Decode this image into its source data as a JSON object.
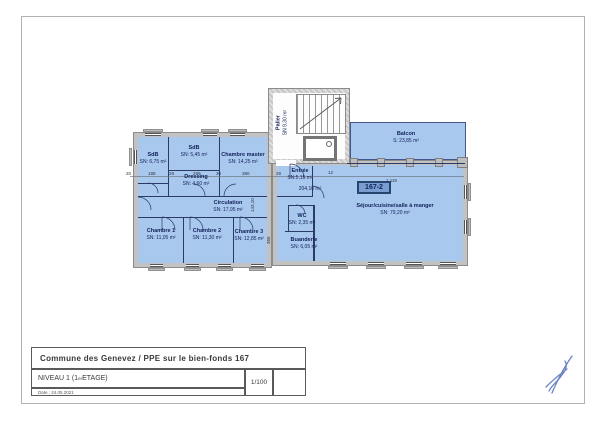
{
  "sheet": {
    "title_block": {
      "title": "Commune des Genevez / PPE sur le bien-fonds 167",
      "level_prefix": "NIVEAU 1 (1",
      "level_sup": "er",
      "level_suffix": " ETAGE)",
      "scale": "1/100",
      "date": "Date : 24.05.2021"
    },
    "icons": {
      "compass_icon": "north-compass",
      "signature_icon": "handwritten-initials"
    },
    "colors": {
      "room_fill": "#a8c8ee",
      "wall_gray": "#c2c2c2",
      "badge_bg": "#7b9cd0",
      "badge_border": "#24466e",
      "line_navy": "#2c3a66",
      "signature_blue": "#5c77bd"
    }
  },
  "plan": {
    "unit_badge": "167-2",
    "total_area": "204,10 m²",
    "rooms": [
      {
        "name": "SdB",
        "area": "SN: 6,75 m²"
      },
      {
        "name": "SdB",
        "area": "SN: 5,45 m²"
      },
      {
        "name": "Dressing",
        "area": "SN: 4,60 m²"
      },
      {
        "name": "Chambre master",
        "area": "SN: 14,25 m²"
      },
      {
        "name": "Circulation",
        "area": "SN: 17,95 m²"
      },
      {
        "name": "Chambre 1",
        "area": "SN: 11,05 m²"
      },
      {
        "name": "Chambre 2",
        "area": "SN: 11,30 m²"
      },
      {
        "name": "Chambre 3",
        "area": "SN: 12,85 m²"
      },
      {
        "name": "Palier",
        "area": "SN 9,30 m²"
      },
      {
        "name": "Entrée",
        "area": "SN:5,15 m²"
      },
      {
        "name": "Balcon",
        "area": "S: 23,85 m²"
      },
      {
        "name": "Séjour/cuisine/salle à manger",
        "area": "SN: 79,20 m²"
      },
      {
        "name": "WC",
        "area": "SN: 2,35 m²"
      },
      {
        "name": "Buanderie",
        "area": "SN: 6,05 m²"
      }
    ],
    "dimensions": {
      "h": [
        "20",
        "188",
        "28",
        "299",
        "30",
        "380",
        "28",
        "12",
        "1 119"
      ],
      "v": [
        "143,10",
        "366"
      ]
    }
  }
}
